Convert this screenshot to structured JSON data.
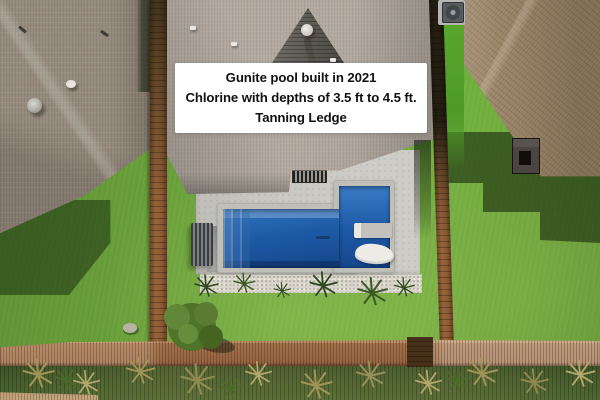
{
  "caption": {
    "lines": [
      "Gunite pool built in 2021",
      "Chlorine with depths of 3.5 ft to 4.5 ft.",
      "Tanning Ledge"
    ]
  },
  "theme": {
    "grass-base": "#6ba43c",
    "grass-dark": "#2f4b1e",
    "pool-deep": "#16498e",
    "pool-mid": "#1d5aa6",
    "pool-light": "#3274bf",
    "pool-step": "#7fa8d8",
    "coping": "#bfbfb8",
    "deck-concrete": "#c9c7c0",
    "gravel": "#d9d5ca",
    "roof-left": "#968b7e",
    "roof-main": "#b3aaa0",
    "gable-dark": "#5d5953",
    "roof-right": "#a18a6c",
    "fence-wood": "#8a5a33",
    "fence-rail": "#a4714a",
    "bench-slate": "#45494b",
    "lounger-white": "#edece6",
    "caption-bg": "#ffffff",
    "caption-text": "#111111"
  }
}
